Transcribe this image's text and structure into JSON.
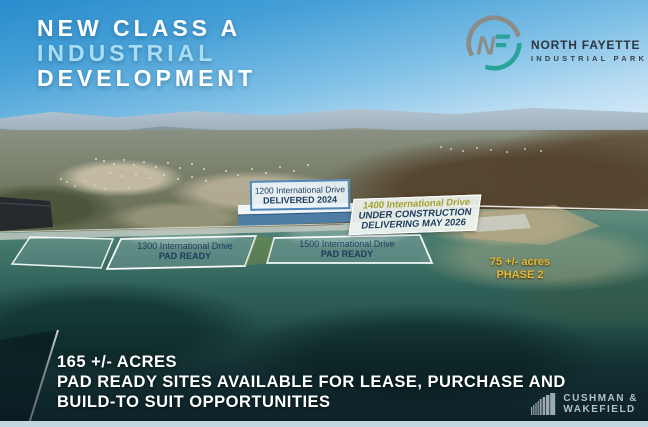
{
  "title": {
    "line1": "NEW CLASS A",
    "line2": "INDUSTRIAL",
    "line3": "DEVELOPMENT"
  },
  "park_logo": {
    "monogram_n": "N",
    "monogram_f": "F",
    "name": "NORTH FAYETTE",
    "subtitle": "INDUSTRIAL PARK"
  },
  "site_labels": {
    "b1200": {
      "line1": "1200 International Drive",
      "line2": "DELIVERED 2024"
    },
    "b1400": {
      "line1": "1400 International Drive",
      "line2": "UNDER CONSTRUCTION",
      "line3": "DELIVERING MAY 2026"
    },
    "pad1300": {
      "line1": "1300 International Drive",
      "line2": "PAD READY"
    },
    "pad1500": {
      "line1": "1500 International Drive",
      "line2": "PAD READY"
    },
    "phase2": {
      "line1": "75 +/- acres",
      "line2": "PHASE 2"
    }
  },
  "footer": {
    "line1": "165 +/- ACRES",
    "line2": "PAD READY SITES AVAILABLE FOR LEASE, PURCHASE AND",
    "line3": "BUILD-TO SUIT OPPORTUNITIES"
  },
  "broker": {
    "line1": "CUSHMAN &",
    "line2": "WAKEFIELD"
  },
  "colors": {
    "title_accent": "#a9dcf5",
    "label_navy": "#1d3c5e",
    "phase_gold": "#e6b733",
    "logo_teal": "#2aa39b",
    "logo_gray": "#8b8b88",
    "construction_olive": "#a3a32f"
  }
}
